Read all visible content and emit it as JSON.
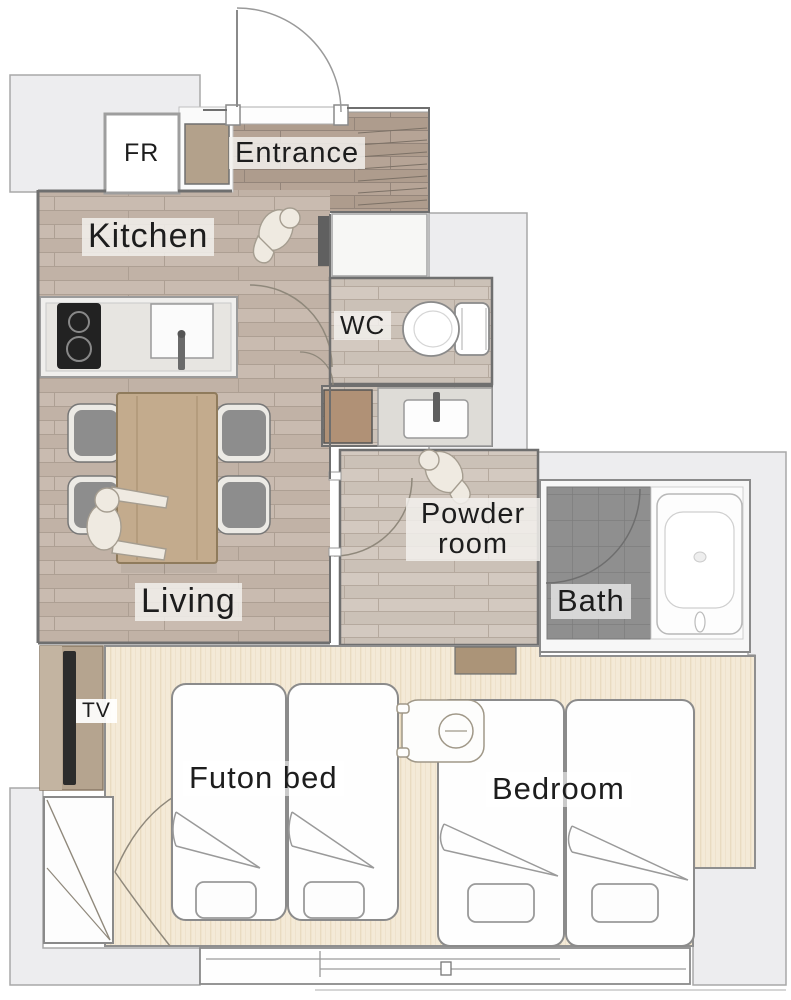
{
  "document": {
    "type": "apartment-floor-plan"
  },
  "rooms": {
    "entrance": "Entrance",
    "kitchen": "Kitchen",
    "wc": "WC",
    "powder_room_line1": "Powder",
    "powder_room_line2": "room",
    "bath": "Bath",
    "living": "Living",
    "futon_bed_room": "Futon bed",
    "bedroom": "Bedroom"
  },
  "fixtures": {
    "fridge": "FR",
    "tv": "TV"
  },
  "colors": {
    "wood_floor": "#c9bbb0",
    "entrance_floor": "#b6a496",
    "wet_area_floor": "#d3c9c0",
    "tatami_floor": "#f4ead7",
    "bath_tile": "#8f8f8f",
    "exterior_area": "#ededef",
    "wall_line": "#6f6f6f",
    "furniture_wood": "#c3ab8d",
    "label_text": "#1d1d1d"
  }
}
